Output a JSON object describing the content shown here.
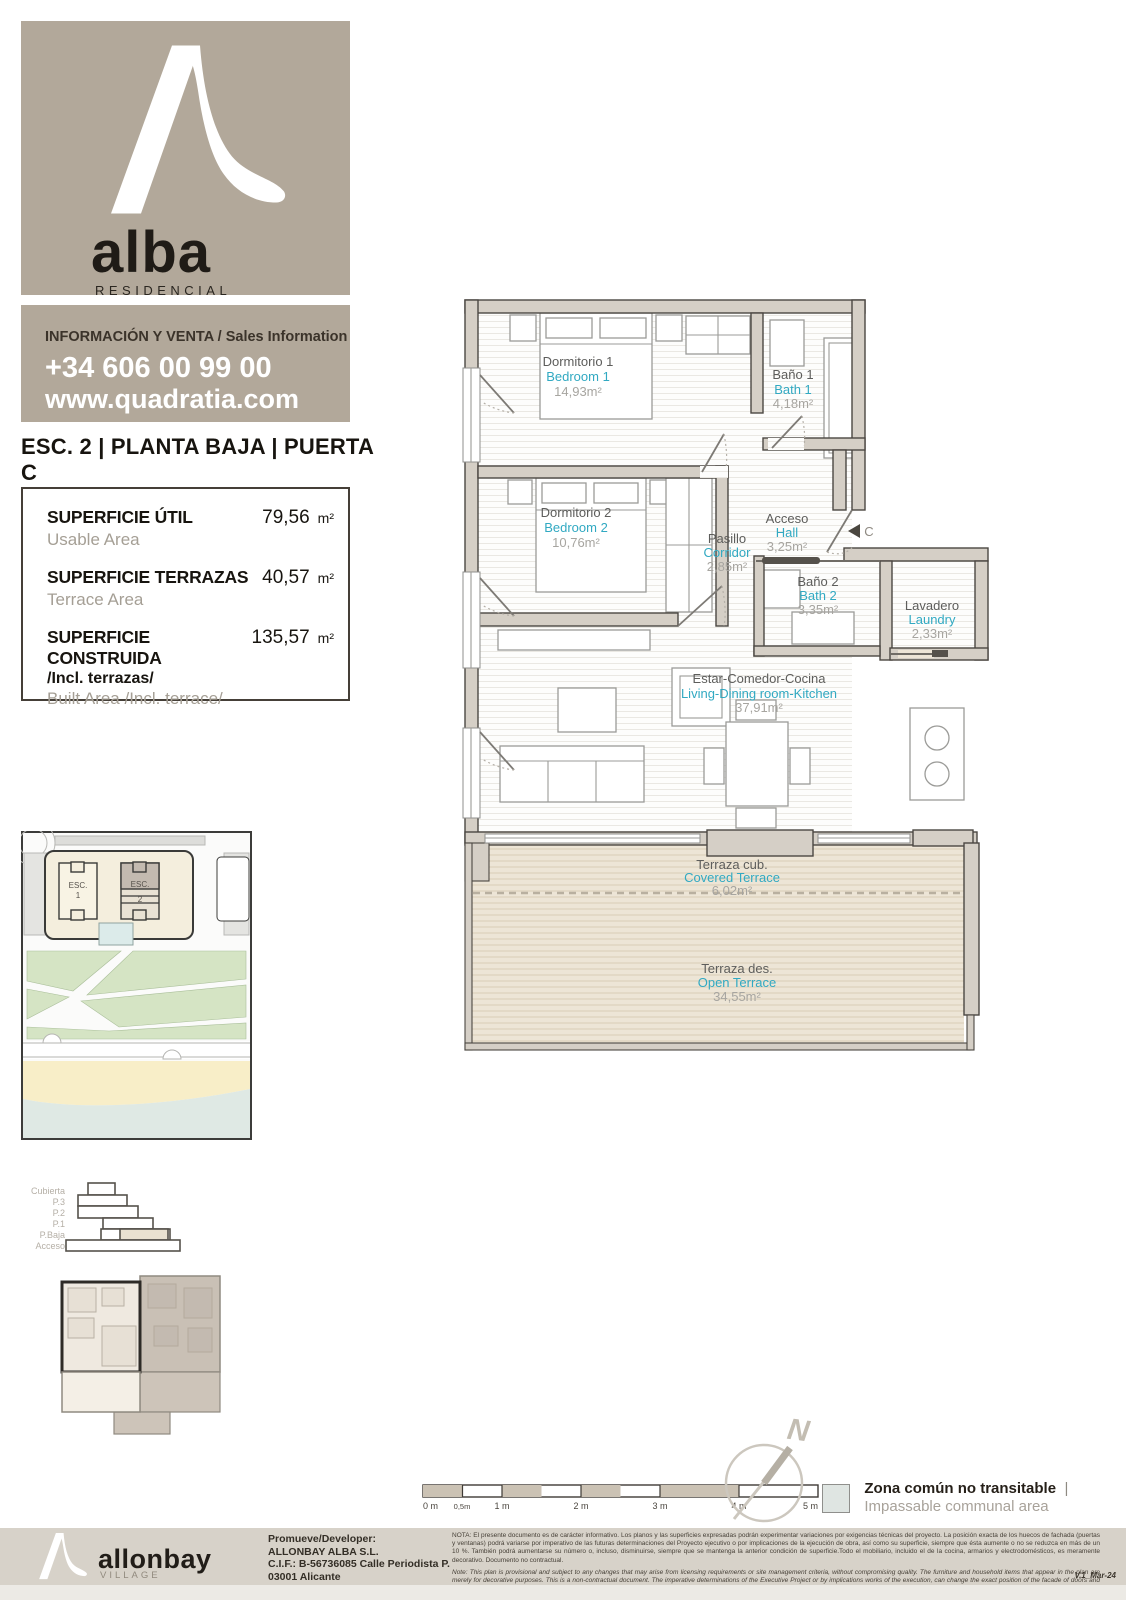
{
  "brand": {
    "name": "alba",
    "tagline": "RESIDENCIAL",
    "info_label": "INFORMACIÓN Y VENTA / Sales Information",
    "phone": "+34 606 00 99 00",
    "website": "www.quadratia.com"
  },
  "unit": {
    "title": "ESC. 2 | PLANTA BAJA | PUERTA C",
    "subtitle": "Staircase 2 | Ground Floor | Door C"
  },
  "areas": {
    "rows": [
      {
        "label_es": "SUPERFICIE ÚTIL",
        "label_en": "Usable Area",
        "value": "79,56",
        "unit": "m²"
      },
      {
        "label_es": "SUPERFICIE TERRAZAS",
        "label_en": "Terrace Area",
        "value": "40,57",
        "unit": "m²"
      },
      {
        "label_es": "SUPERFICIE CONSTRUIDA",
        "label_extra": "/Incl. terrazas/",
        "label_en": "Built Area /Incl. terrace/",
        "value": "135,57",
        "unit": "m²"
      }
    ]
  },
  "plan": {
    "rooms": [
      {
        "name_es": "Dormitorio 1",
        "name_en": "Bedroom 1",
        "area": "14,93m²"
      },
      {
        "name_es": "Baño 1",
        "name_en": "Bath 1",
        "area": "4,18m²"
      },
      {
        "name_es": "Dormitorio 2",
        "name_en": "Bedroom 2",
        "area": "10,76m²"
      },
      {
        "name_es": "Pasillo",
        "name_en": "Corridor",
        "area": "2,85m²"
      },
      {
        "name_es": "Acceso",
        "name_en": "Hall",
        "area": "3,25m²"
      },
      {
        "name_es": "Baño 2",
        "name_en": "Bath 2",
        "area": "3,35m²"
      },
      {
        "name_es": "Lavadero",
        "name_en": "Laundry",
        "area": "2,33m²"
      },
      {
        "name_es": "Estar-Comedor-Cocina",
        "name_en": "Living-Dining room-Kitchen",
        "area": "37,91m²"
      },
      {
        "name_es": "Terraza cub.",
        "name_en": "Covered Terrace",
        "area": "6,02m²"
      },
      {
        "name_es": "Terraza des.",
        "name_en": "Open Terrace",
        "area": "34,55m²"
      }
    ],
    "door_marker": "C"
  },
  "site_map": {
    "buildings": [
      {
        "label": "ESC.",
        "number": "1"
      },
      {
        "label": "ESC.",
        "number": "2"
      }
    ]
  },
  "section": {
    "levels": [
      "Cubierta",
      "P.3",
      "P.2",
      "P.1",
      "P.Baja",
      "Acceso"
    ]
  },
  "scale_bar": {
    "labels": [
      "0 m",
      "0,5m",
      "1 m",
      "2 m",
      "3 m",
      "4 m",
      "5 m"
    ]
  },
  "compass": {
    "north": "N"
  },
  "legend": {
    "label_es": "Zona común no transitable",
    "separator": "|",
    "label_en": "Impassable communal area"
  },
  "footer": {
    "brand": "allonbay",
    "brand_sub": "VILLAGE",
    "developer_lines": [
      "Promueve/Developer:",
      "ALLONBAY ALBA S.L.",
      "C.I.F.: B-56736085 Calle Periodista P.",
      "03001 Alicante"
    ],
    "nota_es": "NOTA:  El presente documento es de carácter informativo. Los planos y las superficies expresadas podrán experimentar variaciones por exigencias técnicas del proyecto. La posición exacta de los huecos de fachada (puertas y ventanas) podrá variarse por imperativo de las futuras determinaciones del Proyecto ejecutivo o por implicaciones de la ejecución de obra, así como su superficie, siempre que ésta aumente o no se reduzca en más de un 10 %. También podrá aumentarse su número o, incluso, disminuirse, siempre que se mantenga la anterior condición de superficie.Todo el mobiliario, incluido el de la cocina, armarios y electrodomésticos, es meramente decorativo. Documento no contractual.",
    "nota_en": "Note: This plan is provisional and subject to any changes that may arise from licensing requirements or site management criteria, without compromising quality. The furniture and household items that appear in the plan are merely for decorative purposes. This is a non-contractual document. The imperative determinations of the Executive Project or by implications works of the execution, can change the exact position of the facade of doors and windows, as well the surface area may also be increased or even decrease not more than a 10%.",
    "version": "V.1_Mar-24"
  }
}
